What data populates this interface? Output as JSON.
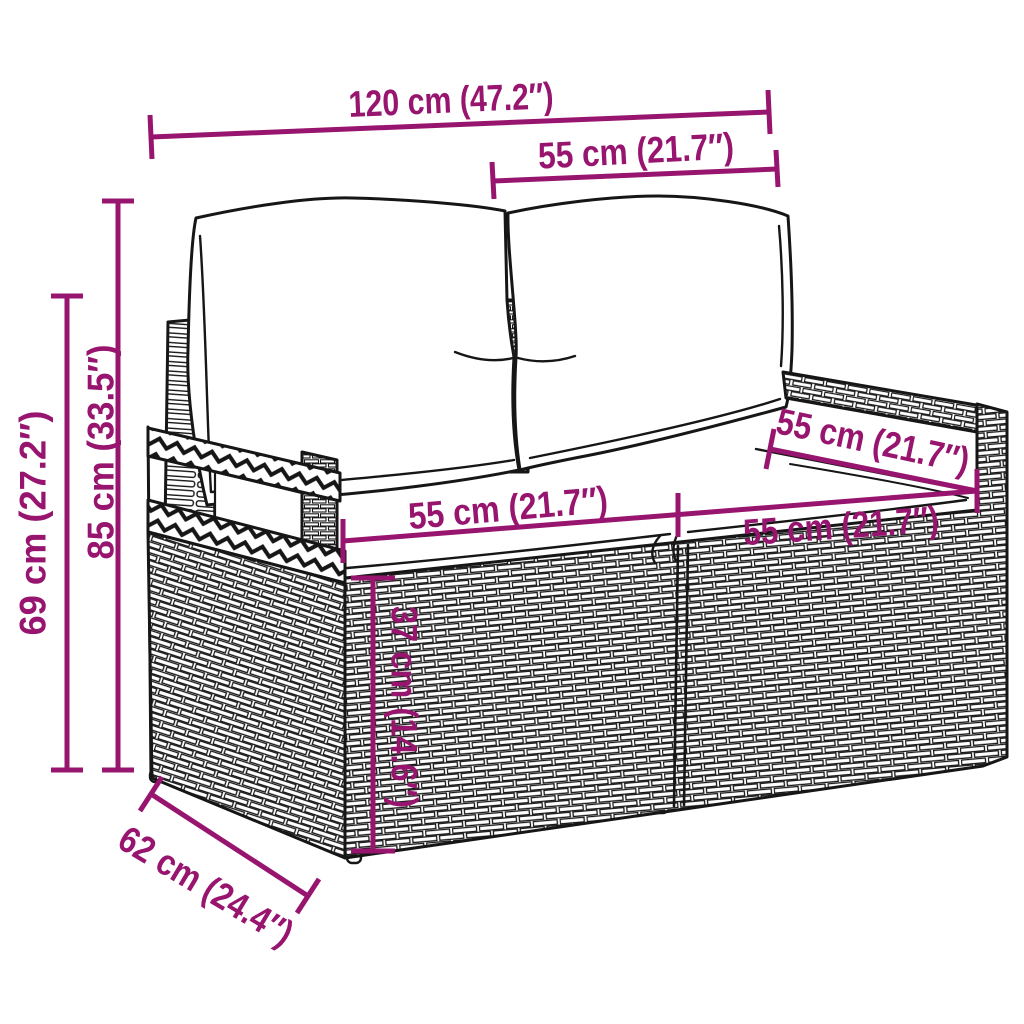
{
  "style": {
    "accent": "#98156F",
    "ink": "#161616",
    "background": "#FFFFFF"
  },
  "figure": {
    "kind": "product-dimension-line-drawing",
    "subject": "poly rattan 2-seater garden sofa with back and seat cushions"
  },
  "dims": {
    "overall_width": {
      "label": "120 cm (47.2″)",
      "cm": 120,
      "in": 47.2
    },
    "backrest_width": {
      "label": "55 cm (21.7″)",
      "cm": 55,
      "in": 21.7
    },
    "total_height": {
      "label": "85 cm (33.5″)",
      "cm": 85,
      "in": 33.5
    },
    "armrest_height": {
      "label": "69 cm (27.2″)",
      "cm": 69,
      "in": 27.2
    },
    "seat_depth_top": {
      "label": "55 cm (21.7″)",
      "cm": 55,
      "in": 21.7
    },
    "seat_width_left": {
      "label": "55 cm (21.7″)",
      "cm": 55,
      "in": 21.7
    },
    "seat_width_right": {
      "label": "55 cm (21.7″)",
      "cm": 55,
      "in": 21.7
    },
    "seat_height": {
      "label": "37 cm (14.6″)",
      "cm": 37,
      "in": 14.6
    },
    "base_depth": {
      "label": "62 cm (24.4″)",
      "cm": 62,
      "in": 24.4
    }
  }
}
